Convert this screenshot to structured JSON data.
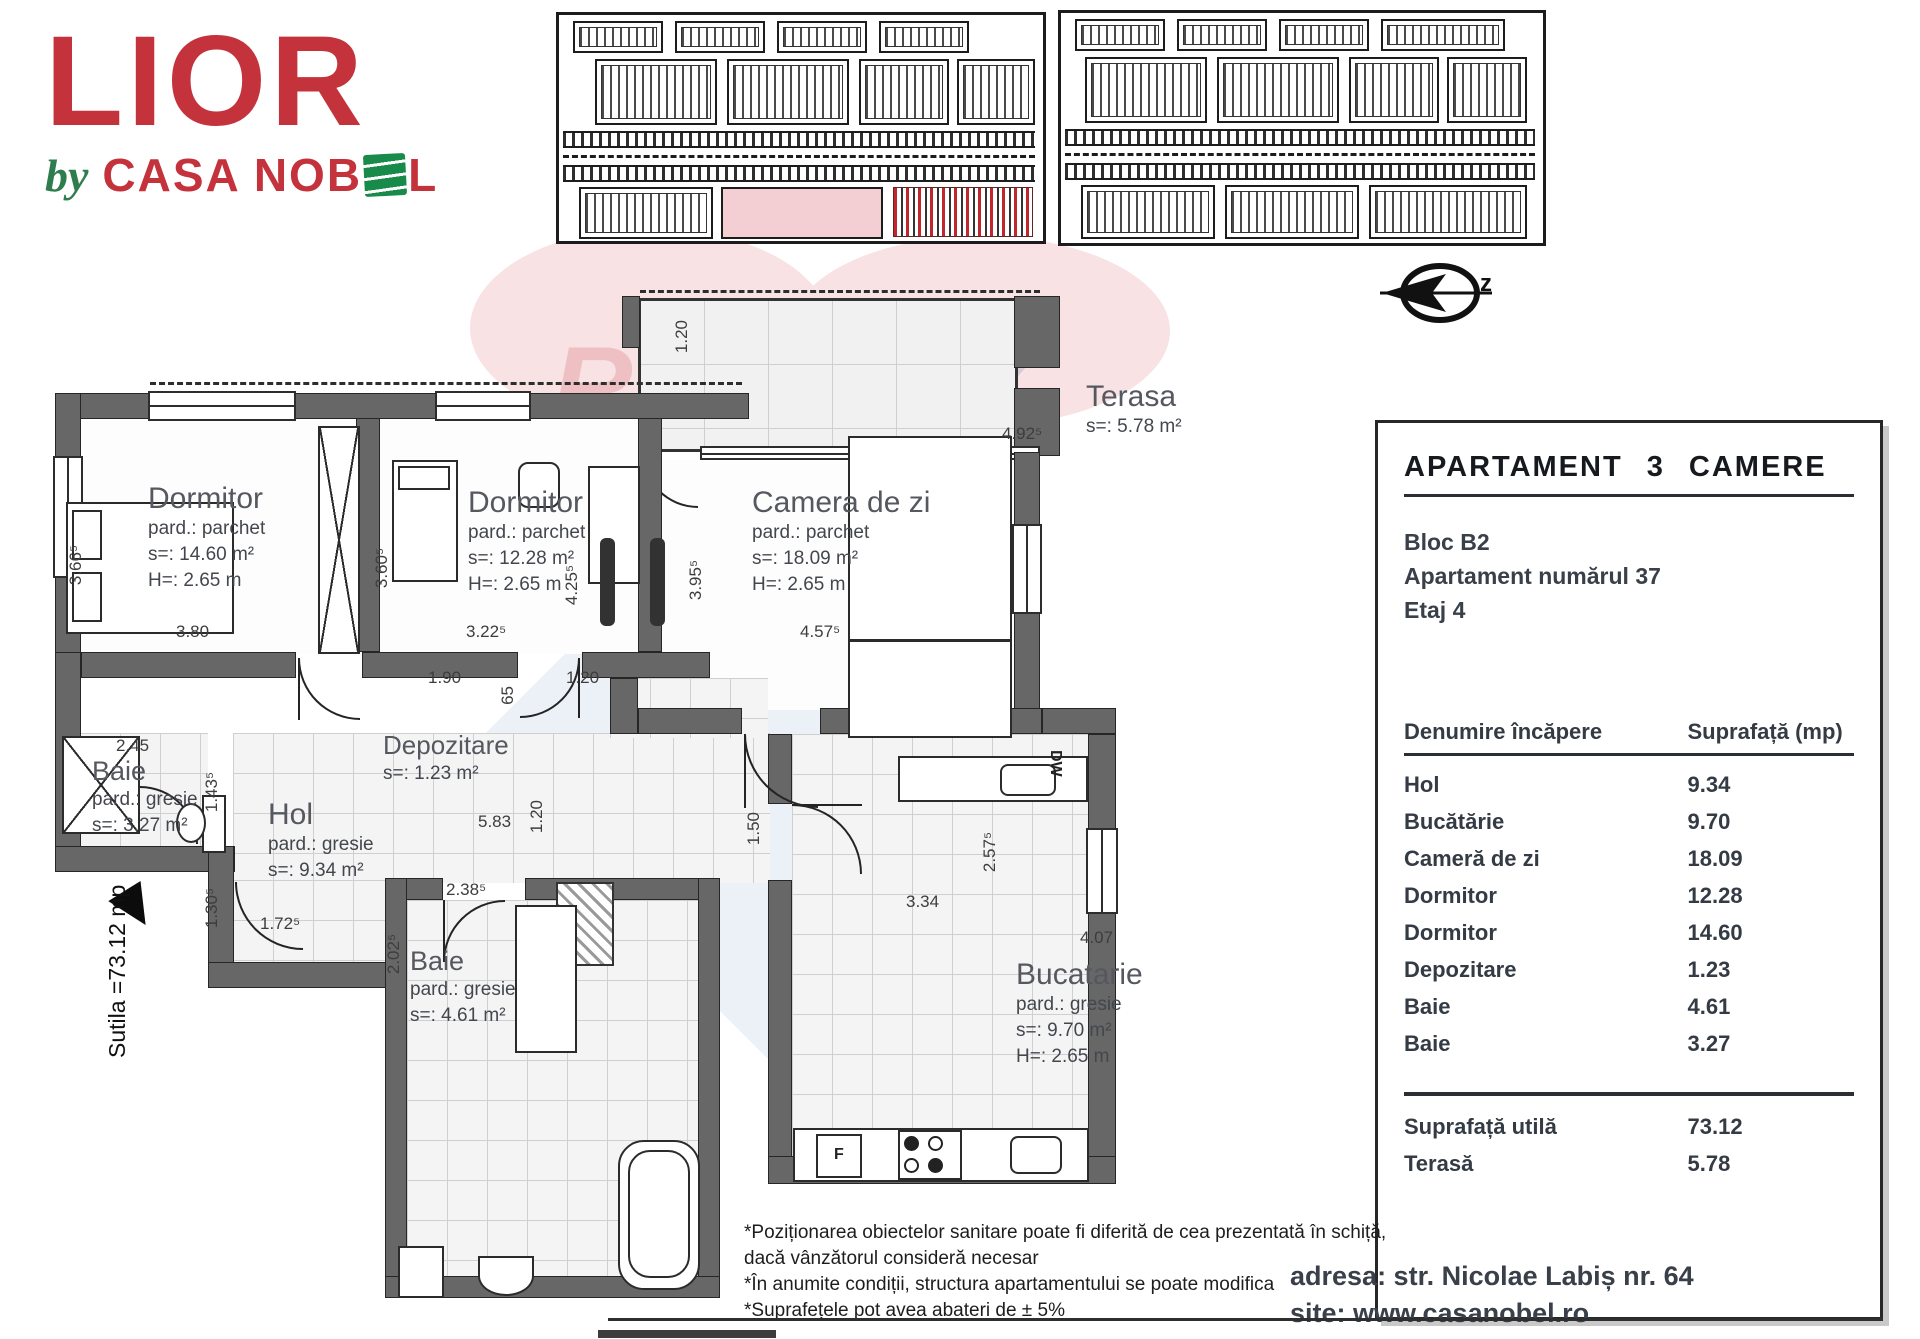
{
  "logo": {
    "brand": "LIOR",
    "by": "by",
    "company_pre": "CASA NOB",
    "company_post": "L",
    "company_full": "CASA NOBEL"
  },
  "compass": {
    "letter": "z"
  },
  "watermark": {
    "part1": "RE/",
    "part2": "MAX"
  },
  "panel": {
    "title": "APARTAMENT  3  CAMERE",
    "block": "Bloc B2",
    "apartment": "Apartament numărul 37",
    "floor": "Etaj 4",
    "table": {
      "col_name": "Denumire încăpere",
      "col_area": "Suprafață (mp)",
      "rows": [
        {
          "name": "Hol",
          "value": "9.34"
        },
        {
          "name": "Bucătărie",
          "value": "9.70"
        },
        {
          "name": "Cameră de zi",
          "value": "18.09"
        },
        {
          "name": "Dormitor",
          "value": "12.28"
        },
        {
          "name": "Dormitor",
          "value": "14.60"
        },
        {
          "name": "Depozitare",
          "value": "1.23"
        },
        {
          "name": "Baie",
          "value": "4.61"
        },
        {
          "name": "Baie",
          "value": "3.27"
        }
      ],
      "totals": [
        {
          "name": "Suprafață utilă",
          "value": "73.12"
        },
        {
          "name": "Terasă",
          "value": "5.78"
        }
      ]
    },
    "address": "adresa: str. Nicolae Labiș nr. 64",
    "site": "site: www.casanobel.ro"
  },
  "footnotes": {
    "line1": "*Poziționarea obiectelor sanitare poate fi diferită de cea prezentată în schiță,",
    "line2": "dacă vânzătorul consideră necesar",
    "line3": "*În anumite condiții, structura apartamentului se poate modifica",
    "line4": "*Suprafețele pot avea abateri de ± 5%"
  },
  "floorplan": {
    "side_label": "Sutila =73.12 mp",
    "kitchen": {
      "fridge": "F",
      "dishwasher": "DW"
    },
    "rooms": [
      {
        "name": "Dormitor",
        "subs": [
          "pard.: parchet",
          "s=: 14.60 m²",
          "H=: 2.65 m"
        ]
      },
      {
        "name": "Dormitor",
        "subs": [
          "pard.: parchet",
          "s=: 12.28 m²",
          "H=: 2.65 m"
        ]
      },
      {
        "name": "Camera de zi",
        "subs": [
          "pard.: parchet",
          "s=: 18.09 m²",
          "H=: 2.65 m"
        ]
      },
      {
        "name": "Terasa",
        "subs": [
          "s=: 5.78 m²"
        ]
      },
      {
        "name": "Depozitare",
        "subs": [
          "s=: 1.23 m²"
        ]
      },
      {
        "name": "Hol",
        "subs": [
          "pard.: gresie",
          "s=: 9.34 m²"
        ]
      },
      {
        "name": "Baie",
        "subs": [
          "pard.: gresie",
          "s=: 3.27 m²"
        ]
      },
      {
        "name": "Baie",
        "subs": [
          "pard.: gresie",
          "s=: 4.61 m²"
        ]
      },
      {
        "name": "Bucatarie",
        "subs": [
          "pard.: gresie",
          "s=: 9.70 m²",
          "H=: 2.65 m"
        ]
      }
    ],
    "dims": [
      {
        "v": "3.80"
      },
      {
        "v": "3.66⁵"
      },
      {
        "v": "3.60⁵"
      },
      {
        "v": "3.22⁵"
      },
      {
        "v": "4.25⁵"
      },
      {
        "v": "3.95⁵"
      },
      {
        "v": "4.57⁵"
      },
      {
        "v": "1.20"
      },
      {
        "v": "4.92⁵"
      },
      {
        "v": "1.90"
      },
      {
        "v": "1.20"
      },
      {
        "v": "65"
      },
      {
        "v": "2.45"
      },
      {
        "v": "1.43⁵"
      },
      {
        "v": "5.83"
      },
      {
        "v": "1.20"
      },
      {
        "v": "1.50"
      },
      {
        "v": "4.07"
      },
      {
        "v": "2.57⁵"
      },
      {
        "v": "3.34"
      },
      {
        "v": "2.38⁵"
      },
      {
        "v": "1.30⁵"
      },
      {
        "v": "1.72⁵"
      },
      {
        "v": "2.02⁵"
      }
    ]
  }
}
